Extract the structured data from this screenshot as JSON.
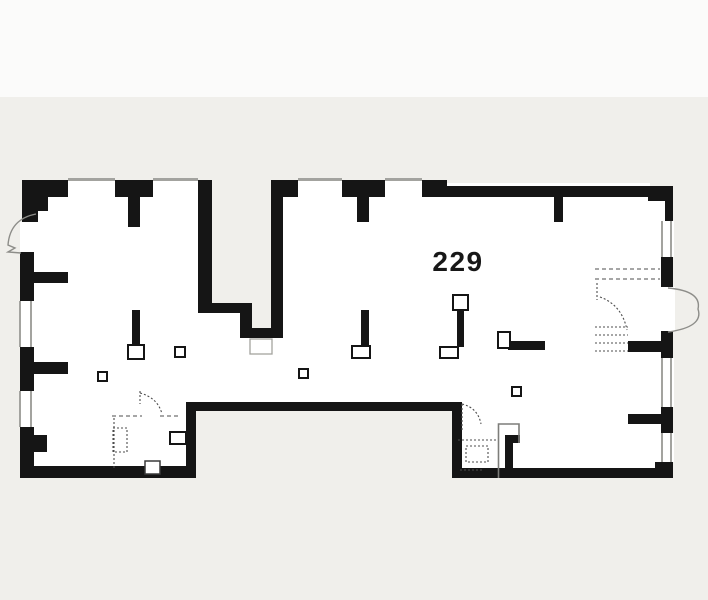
{
  "page": {
    "top_band_color": "#fbfbfa",
    "canvas_color": "#f0efeb"
  },
  "plan": {
    "room_number": "229",
    "colors": {
      "wall": "#151515",
      "interior": "#ffffff",
      "winline": "#a3a39f",
      "arc": "#8d8d89",
      "dash": "#4d4d4d"
    }
  }
}
